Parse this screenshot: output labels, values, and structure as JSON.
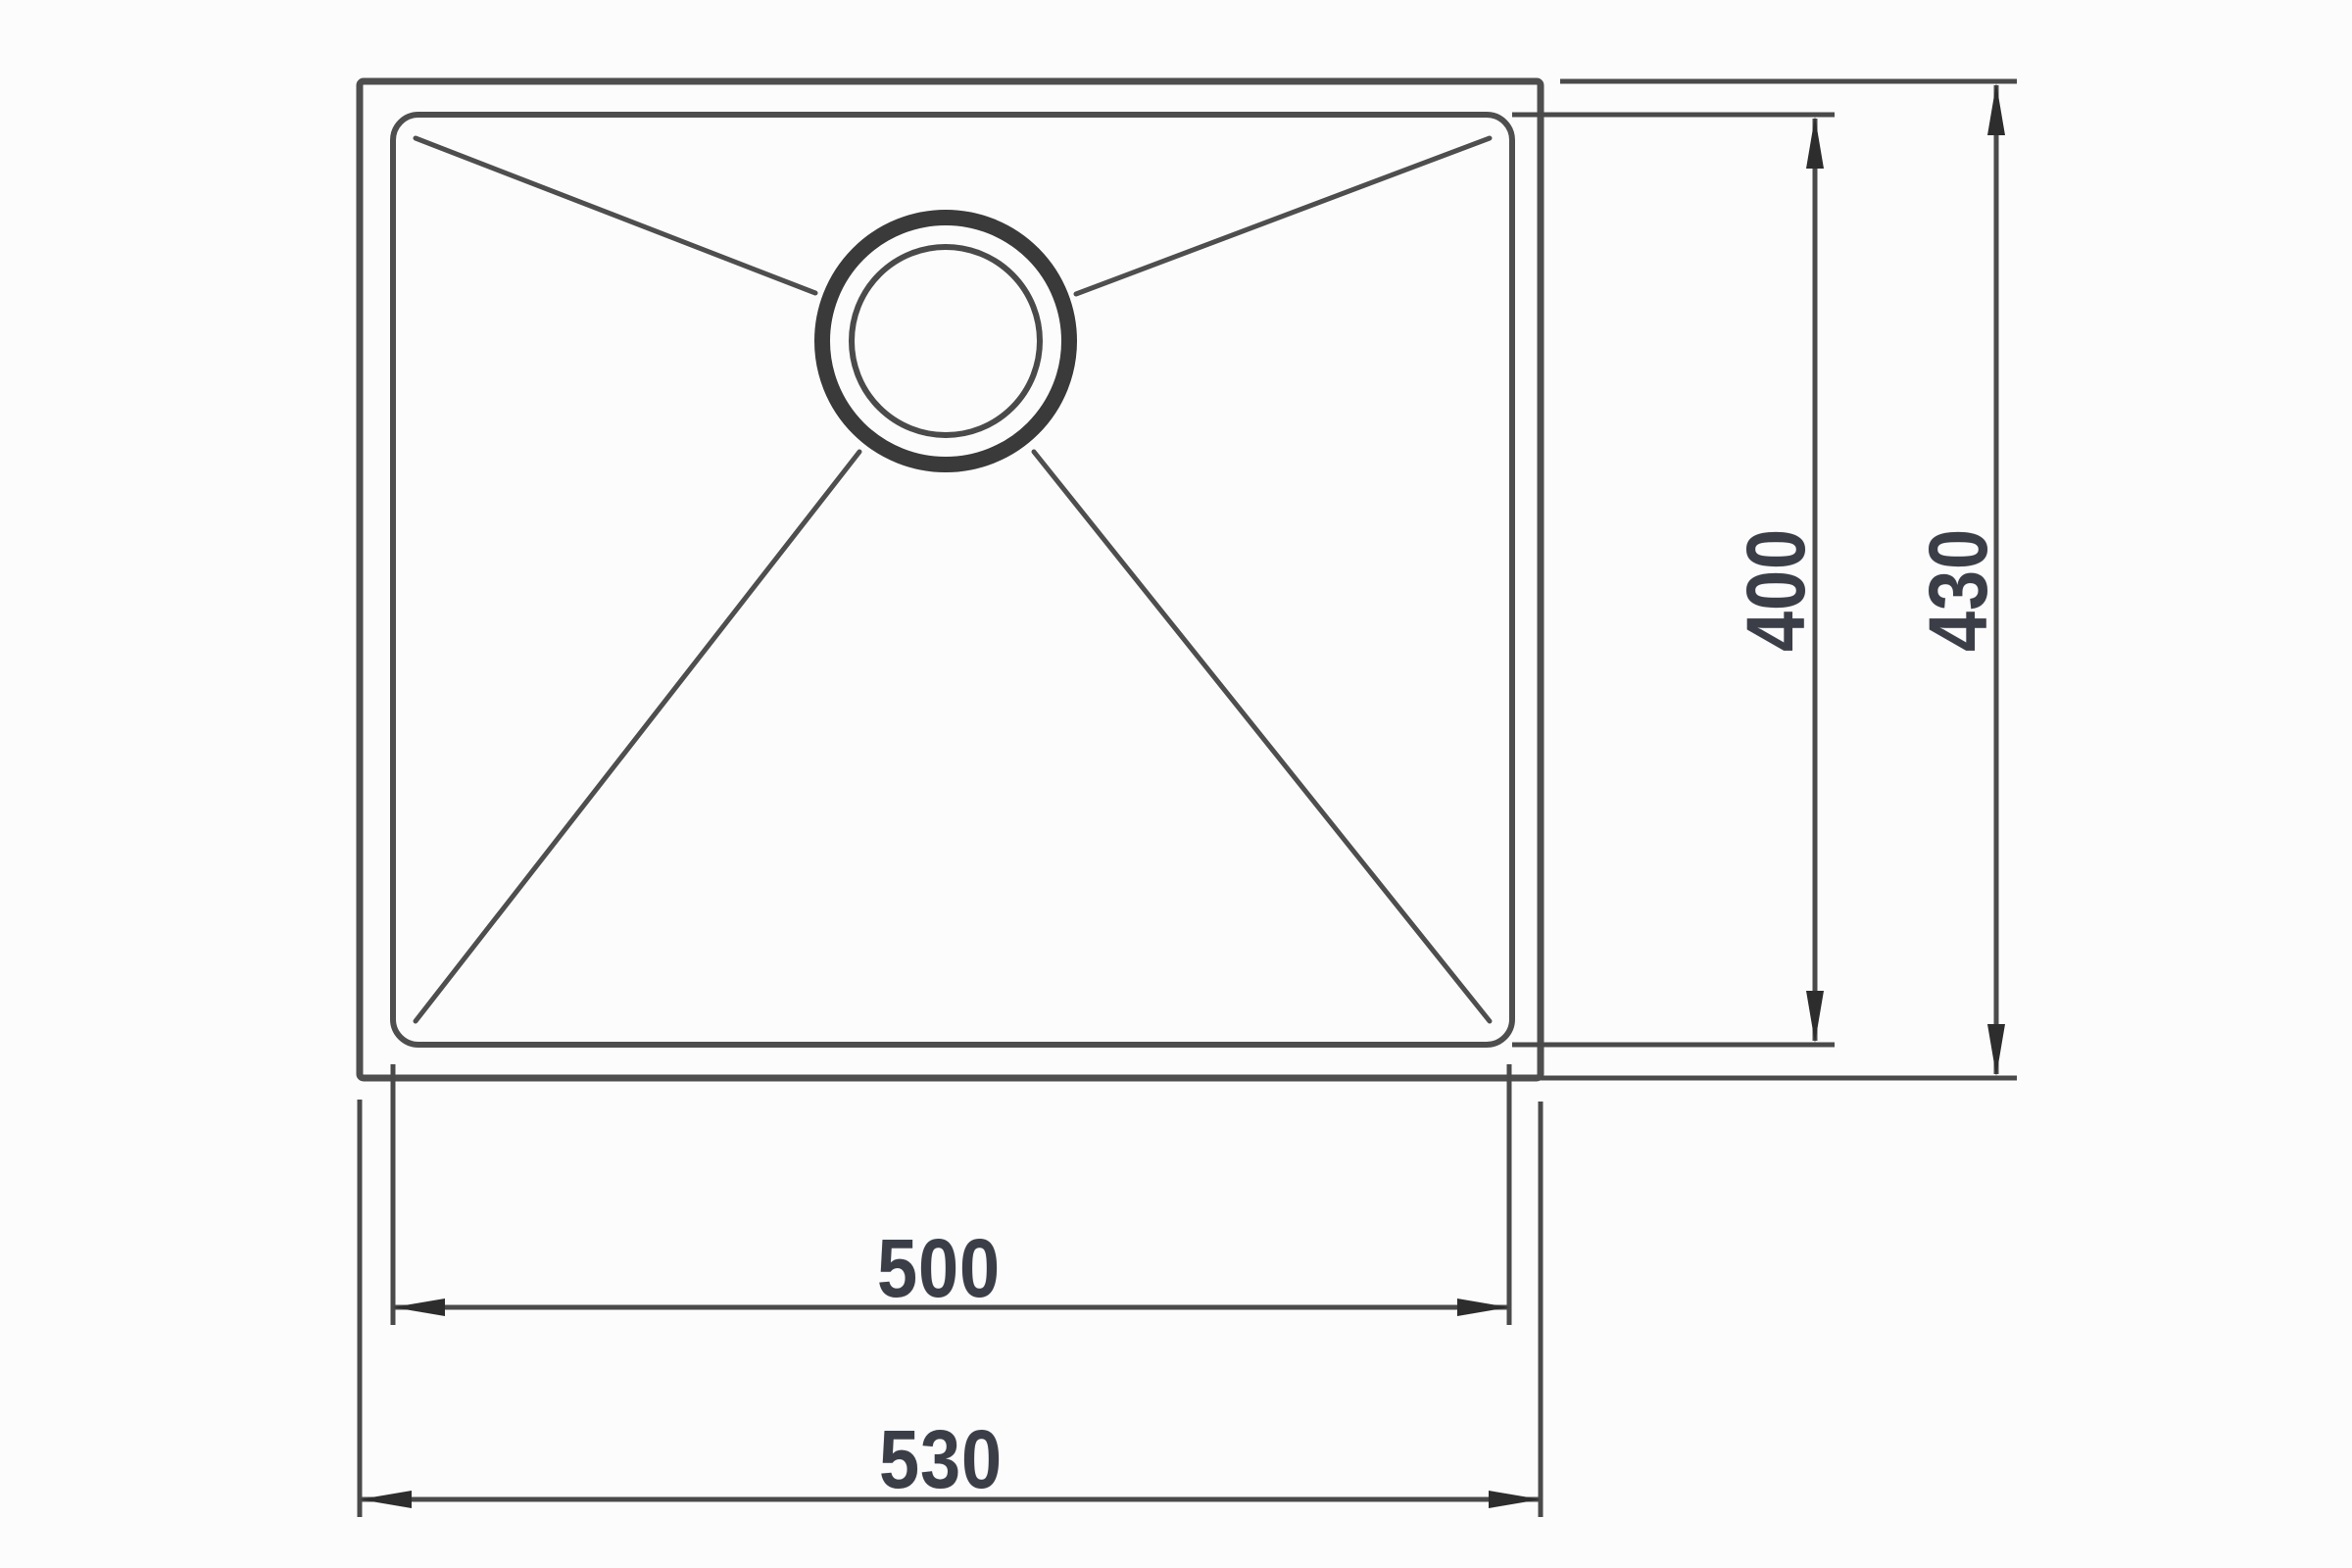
{
  "diagram": {
    "type": "technical-drawing",
    "subject": "single-bowl sink plan view with drain and dimension lines",
    "dimension_labels": {
      "inner_width": "500",
      "outer_width": "530",
      "inner_depth": "400",
      "outer_depth": "430"
    },
    "colors": {
      "background": "#fcfcfc",
      "outline_line": "#4e4e4e",
      "dimension_line": "#4a4a4a",
      "arrow": "#2d2d2d",
      "drain_ring": "#3a3a3a",
      "text": "#3b3e47"
    }
  }
}
